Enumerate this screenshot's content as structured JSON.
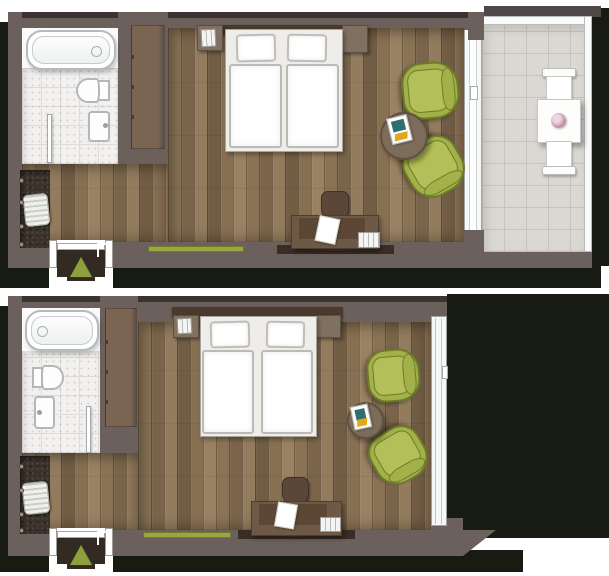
{
  "document": {
    "type": "hotel-room-floor-plans-top-view",
    "plan_count": 2,
    "visible_text": "none"
  },
  "palette": {
    "shadow": "#171b12",
    "wall": "#6c605d",
    "wall-edge": "#3a3331",
    "wardrobe": "#7b6452",
    "headboard": "#4a392c",
    "furniture-brown": "#6d5946",
    "desk-panel": "#5b4734",
    "side-table": "#7d6c59",
    "chair-green": "#a3b14b",
    "chair-green-dark": "#6d7b26",
    "runner-green": "#9aa642",
    "triangle-green": "#8ca03d",
    "tile-bath": "#f2f1ef",
    "tile-bath-grout": "#dedcd8",
    "tile-terrace": "#dbd7d2",
    "tile-terrace-grout": "#c6c2bd",
    "fixture-outline": "#b4b7b8",
    "closet-dark": "#3b332b"
  },
  "plans": [
    {
      "name": "room-with-terrace",
      "rooms": [
        "bathroom",
        "sleeping-area",
        "entrance",
        "terrace"
      ],
      "furniture": [
        "bathtub",
        "toilet",
        "washbasin",
        "bathroom-door",
        "wardrobe",
        "luggage-rack",
        "wall-hooks",
        "double-bed",
        "pillows",
        "duvets",
        "bedside-books",
        "nightstand",
        "green-armchair-top",
        "green-armchair-bottom",
        "round-side-table",
        "magazine",
        "desk",
        "desk-chair",
        "paper-sheet",
        "book-stack",
        "green-runner",
        "entrance-door",
        "entrance-arrow",
        "terrace-table",
        "flower-pot",
        "terrace-chair-top",
        "terrace-chair-bottom",
        "glass-door"
      ]
    },
    {
      "name": "room-with-window",
      "rooms": [
        "bathroom",
        "sleeping-area",
        "entrance"
      ],
      "furniture": [
        "bathtub",
        "toilet",
        "washbasin",
        "bathroom-door",
        "wardrobe",
        "luggage-rack",
        "wall-hooks",
        "double-bed",
        "pillows",
        "duvets",
        "bedside-books",
        "nightstand",
        "green-armchair-top",
        "green-armchair-bottom",
        "round-side-table",
        "magazine",
        "desk",
        "desk-chair",
        "paper-sheet",
        "book-stack",
        "green-runner",
        "entrance-door",
        "entrance-arrow",
        "window"
      ]
    }
  ]
}
